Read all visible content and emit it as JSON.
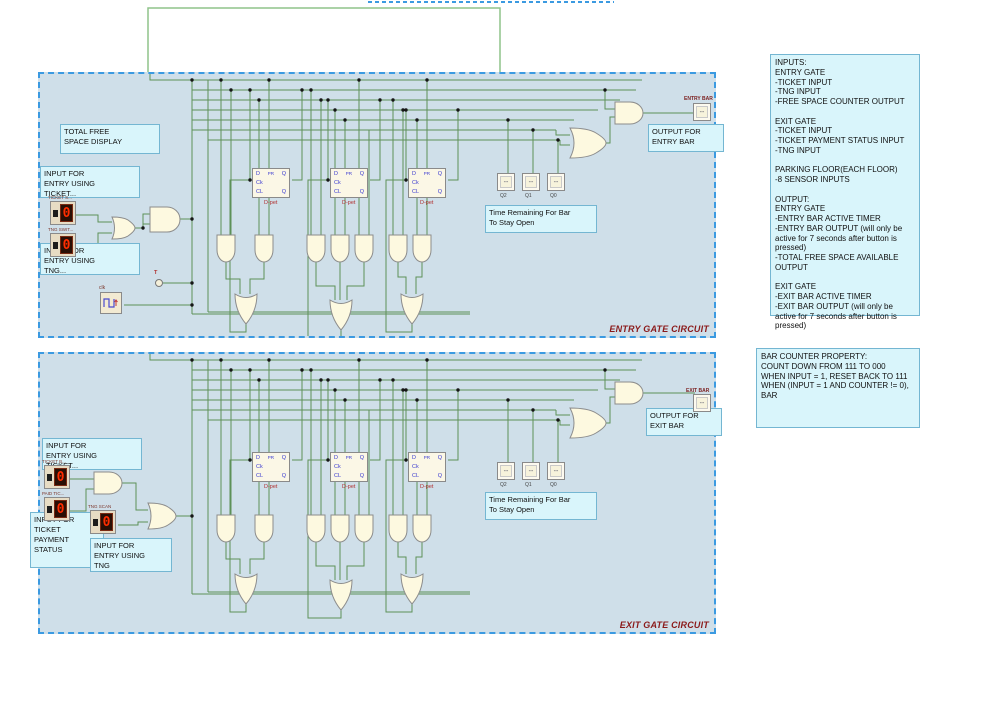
{
  "colors": {
    "wire": "#5d9158",
    "wire_light": "#8fc48a",
    "selection_blue": "#3b9ae1",
    "block_background": "#cfdfe9",
    "note_background": "#d9f5fb",
    "gate_fill": "#fdf9e0",
    "caption_red": "#8b1a1a",
    "digit_red": "#ff2d00"
  },
  "notes": {
    "io_summary": "INPUTS:\nENTRY GATE\n-TICKET INPUT\n-TNG INPUT\n-FREE SPACE COUNTER OUTPUT\n\nEXIT GATE\n-TICKET INPUT\n-TICKET PAYMENT STATUS INPUT\n-TNG INPUT\n\nPARKING FLOOR(EACH FLOOR)\n-8 SENSOR INPUTS\n\nOUTPUT:\nENTRY GATE\n-ENTRY BAR ACTIVE TIMER\n-ENTRY BAR OUTPUT (will only be active for 7 seconds after button is pressed)\n-TOTAL FREE SPACE AVAILABLE OUTPUT\n\nEXIT GATE\n-EXIT BAR ACTIVE TIMER\n-EXIT BAR OUTPUT (will only be active for 7 seconds after button is pressed)",
    "bar_counter": "BAR COUNTER PROPERTY:\nCOUNT DOWN FROM 111 TO 000\nWHEN INPUT = 1, RESET BACK TO 111\nWHEN (INPUT = 1 AND COUNTER != 0), BAR"
  },
  "flipflop": {
    "d": "D",
    "pr": "PR",
    "q": "Q",
    "ck": "Ck",
    "cl": "CL",
    "qb": "Q",
    "caption": "D-pet"
  },
  "pins": {
    "value": "--",
    "q_labels": [
      "Q2",
      "Q1",
      "Q0"
    ]
  },
  "entry": {
    "caption": "ENTRY GATE CIRCUIT",
    "labels": {
      "total_free": "TOTAL FREE\nSPACE DISPLAY",
      "input_ticket": "INPUT FOR\nENTRY USING\nTICKET...",
      "input_tng": "INPUT FOR\nENTRY USING\nTNG...",
      "output_bar": "OUTPUT FOR\nENTRY BAR",
      "time_remaining": "Time Remaining For Bar\nTo Stay Open"
    },
    "switches": [
      {
        "label": "TICKET S...",
        "value": "0"
      },
      {
        "label": "TNG SWIT...",
        "value": "0"
      }
    ],
    "bar_label": "ENTRY BAR",
    "t_label": "T",
    "clk_label": "clk"
  },
  "exit": {
    "caption": "EXIT GATE CIRCUIT",
    "labels": {
      "input_ticket": "INPUT FOR\nENTRY USING\nTICKET...",
      "payment_status": "INPUT FOR\nTICKET\nPAYMENT\nSTATUS",
      "input_tng": "INPUT FOR\nENTRY USING\nTNG",
      "output_bar": "OUTPUT FOR\nEXIT BAR",
      "time_remaining": "Time Remaining For Bar\nTo Stay Open"
    },
    "switches": [
      {
        "label": "TICKET B...",
        "value": "0"
      },
      {
        "label": "PAID TIC...",
        "value": "0"
      },
      {
        "label": "TNG SCAN",
        "value": "0"
      }
    ],
    "bar_label": "EXIT BAR"
  }
}
